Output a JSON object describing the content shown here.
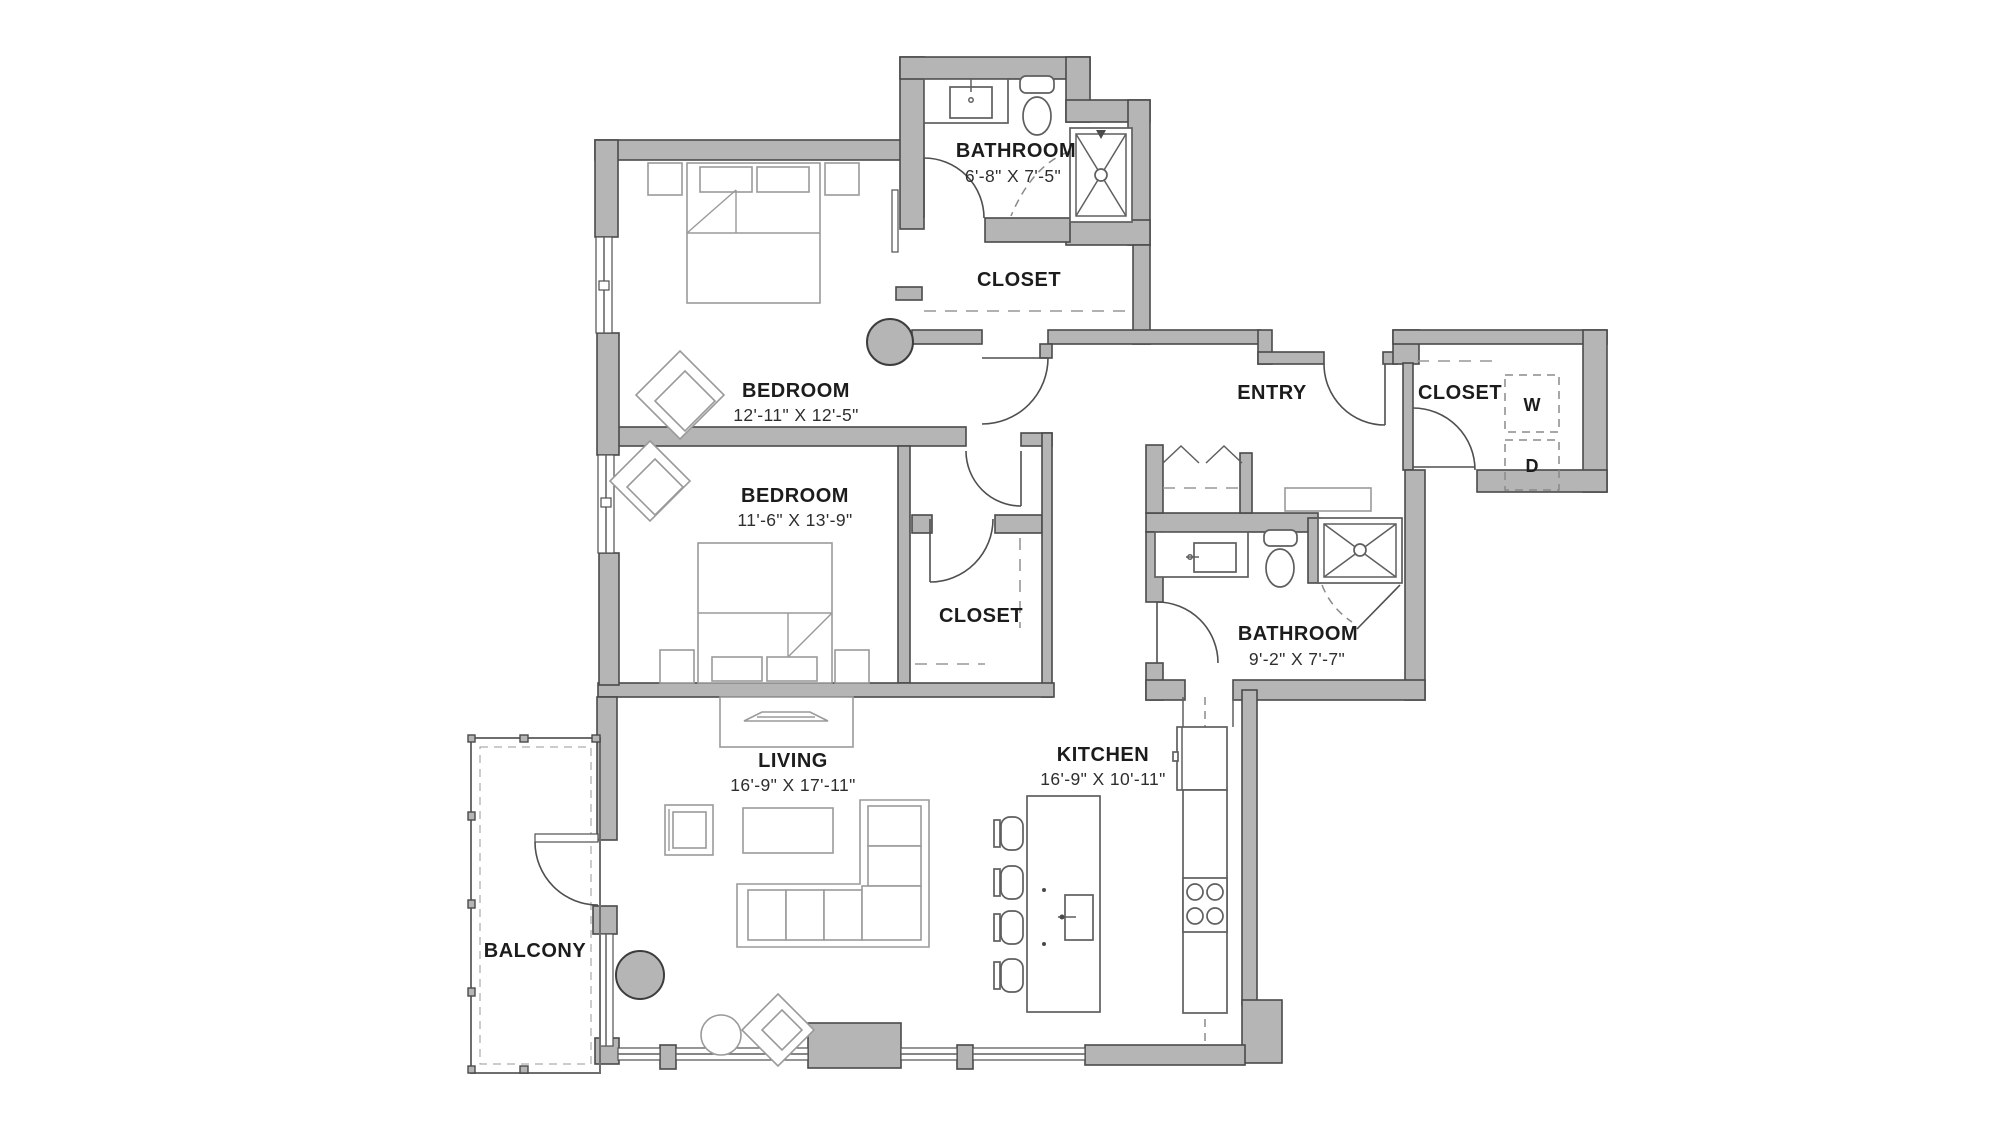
{
  "plan_title": "Two Bedroom Floor Plan",
  "rooms": {
    "bathroom_top": {
      "name": "BATHROOM",
      "dims": "6'-8\" X 7'-5\""
    },
    "closet_top": {
      "name": "CLOSET"
    },
    "bedroom_1": {
      "name": "BEDROOM",
      "dims": "12'-11\" X 12'-5\""
    },
    "bedroom_2": {
      "name": "BEDROOM",
      "dims": "11'-6\" X 13'-9\""
    },
    "closet_bedroom2": {
      "name": "CLOSET"
    },
    "entry": {
      "name": "ENTRY"
    },
    "closet_laundry": {
      "name": "CLOSET",
      "washer": "W",
      "dryer": "D"
    },
    "bathroom_right": {
      "name": "BATHROOM",
      "dims": "9'-2\" X 7'-7\""
    },
    "living": {
      "name": "LIVING",
      "dims": "16'-9\" X 17'-11\""
    },
    "kitchen": {
      "name": "KITCHEN",
      "dims": "16'-9\" X 10'-11\""
    },
    "balcony": {
      "name": "BALCONY"
    }
  },
  "colors": {
    "wall_fill": "#b5b5b5",
    "wall_outline": "#4a4a4a",
    "furniture_line": "#9a9a9a",
    "fixture_line": "#5f5f5f",
    "label_text": "#1c1c1c",
    "background": "#ffffff"
  }
}
